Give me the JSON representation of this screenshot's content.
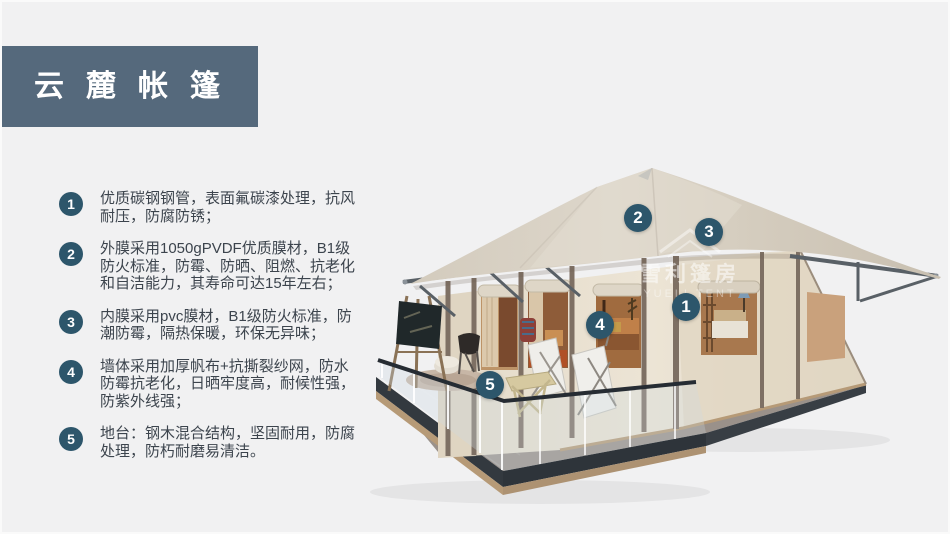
{
  "banner": {
    "title": "云麓帐篷"
  },
  "features": [
    {
      "num": "1",
      "text": "优质碳钢钢管，表面氟碳漆处理，抗风耐压，防腐防锈；"
    },
    {
      "num": "2",
      "text": "外膜采用1050gPVDF优质膜材，B1级防火标准，防霉、防晒、阻燃、抗老化和自洁能力，其寿命可达15年左右；"
    },
    {
      "num": "3",
      "text": "内膜采用pvc膜材，B1级防火标准，防潮防霉，隔热保暖，环保无异味；"
    },
    {
      "num": "4",
      "text": "墙体采用加厚帆布+抗撕裂纱网，防水防霉抗老化，日晒牢度高，耐候性强，防紫外线强；"
    },
    {
      "num": "5",
      "text": "地台：钢木混合结构，坚固耐用，防腐处理，防朽耐磨易清洁。"
    }
  ],
  "markers": [
    {
      "label": "1"
    },
    {
      "label": "2"
    },
    {
      "label": "3"
    },
    {
      "label": "4"
    },
    {
      "label": "5"
    }
  ],
  "watermark": {
    "cn": "雪利篷房",
    "en": "YUELI TENT"
  },
  "colors": {
    "accent": "#2d566b",
    "banner_bg": "#55697c",
    "text_color": "#3c444d",
    "bg": "#f1f1f2",
    "roof": "#d8d0c3",
    "wall": "#eae2d2",
    "deck_fascia": "#33393f",
    "deck_wood": "#b69a77"
  }
}
